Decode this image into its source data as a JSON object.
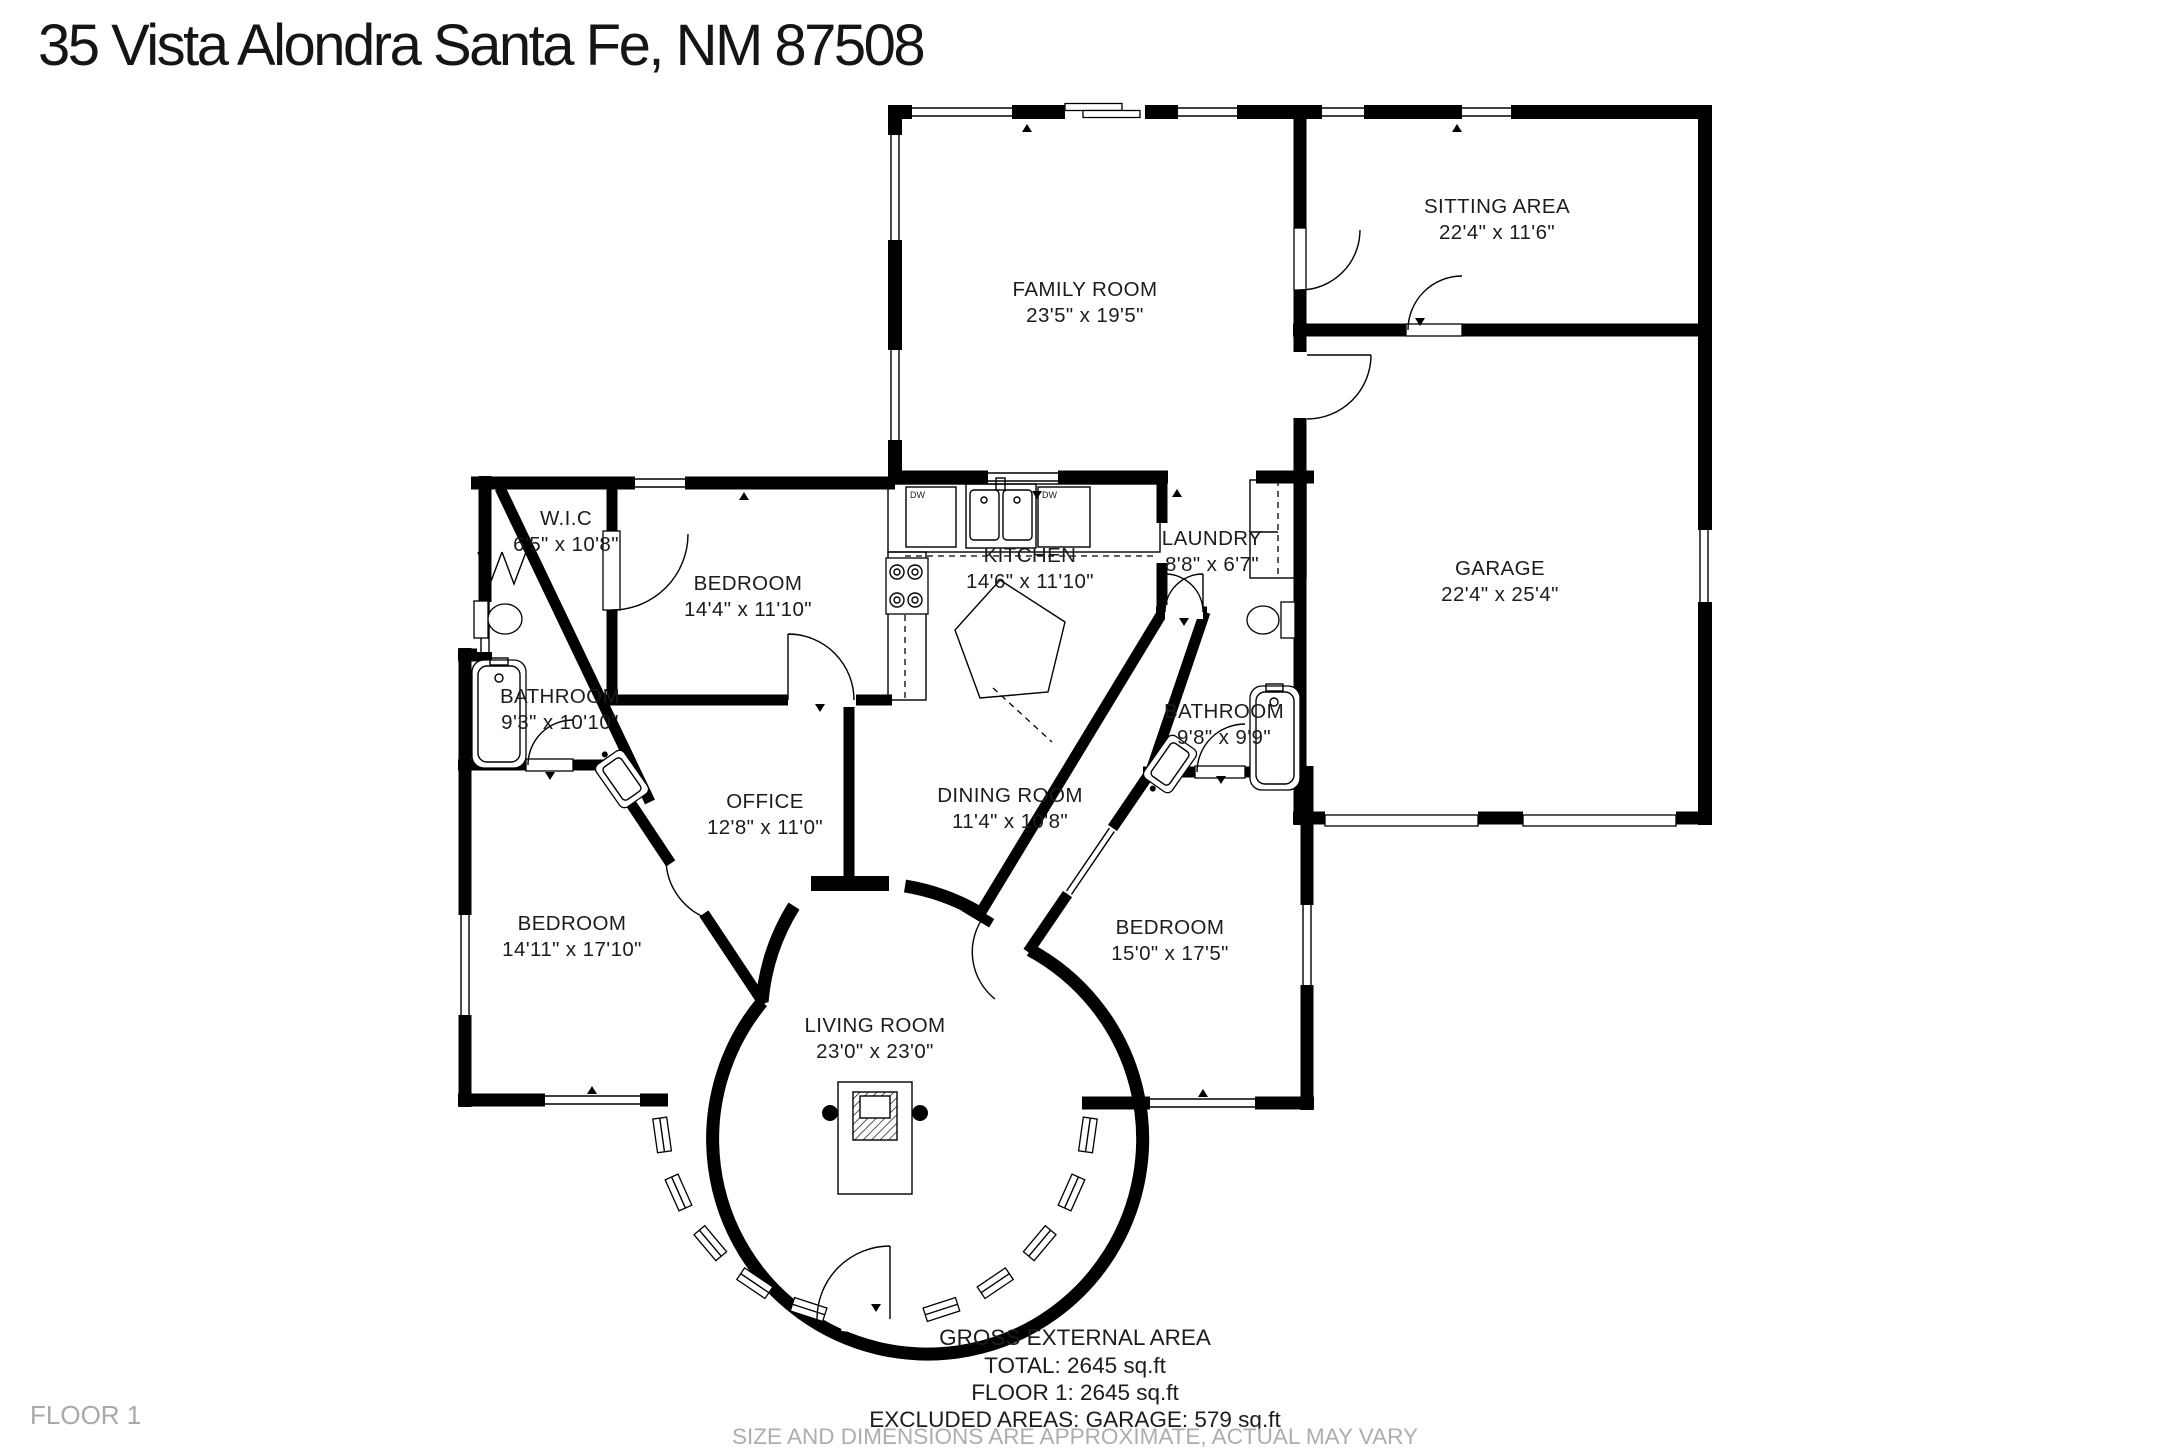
{
  "page": {
    "title": "35 Vista Alondra Santa Fe, NM 87508",
    "floor_label": "FLOOR 1"
  },
  "rooms": [
    {
      "name": "FAMILY ROOM",
      "dims": "23'5\" x 19'5\""
    },
    {
      "name": "SITTING AREA",
      "dims": "22'4\" x 11'6\""
    },
    {
      "name": "GARAGE",
      "dims": "22'4\" x 25'4\""
    },
    {
      "name": "W.I.C",
      "dims": "6'5\" x 10'8\""
    },
    {
      "name": "BEDROOM",
      "dims": "14'4\" x 11'10\""
    },
    {
      "name": "KITCHEN",
      "dims": "14'6\" x 11'10\""
    },
    {
      "name": "LAUNDRY",
      "dims": "8'8\" x 6'7\""
    },
    {
      "name": "BATHROOM",
      "dims": "9'3\" x 10'10\""
    },
    {
      "name": "BATHROOM",
      "dims": "9'8\" x 9'9\""
    },
    {
      "name": "OFFICE",
      "dims": "12'8\" x 11'0\""
    },
    {
      "name": "DINING ROOM",
      "dims": "11'4\" x 10'8\""
    },
    {
      "name": "BEDROOM",
      "dims": "14'11\" x 17'10\""
    },
    {
      "name": "BEDROOM",
      "dims": "15'0\" x 17'5\""
    },
    {
      "name": "LIVING ROOM",
      "dims": "23'0\" x 23'0\""
    }
  ],
  "fixtures": {
    "dishwasher_label": "DW"
  },
  "footer": {
    "line1": "GROSS EXTERNAL AREA",
    "line2": "TOTAL: 2645 sq.ft",
    "line3": "FLOOR 1: 2645 sq.ft",
    "line4": "EXCLUDED AREAS: GARAGE: 579 sq.ft",
    "disclaimer": "SIZE AND DIMENSIONS ARE APPROXIMATE, ACTUAL MAY VARY"
  }
}
